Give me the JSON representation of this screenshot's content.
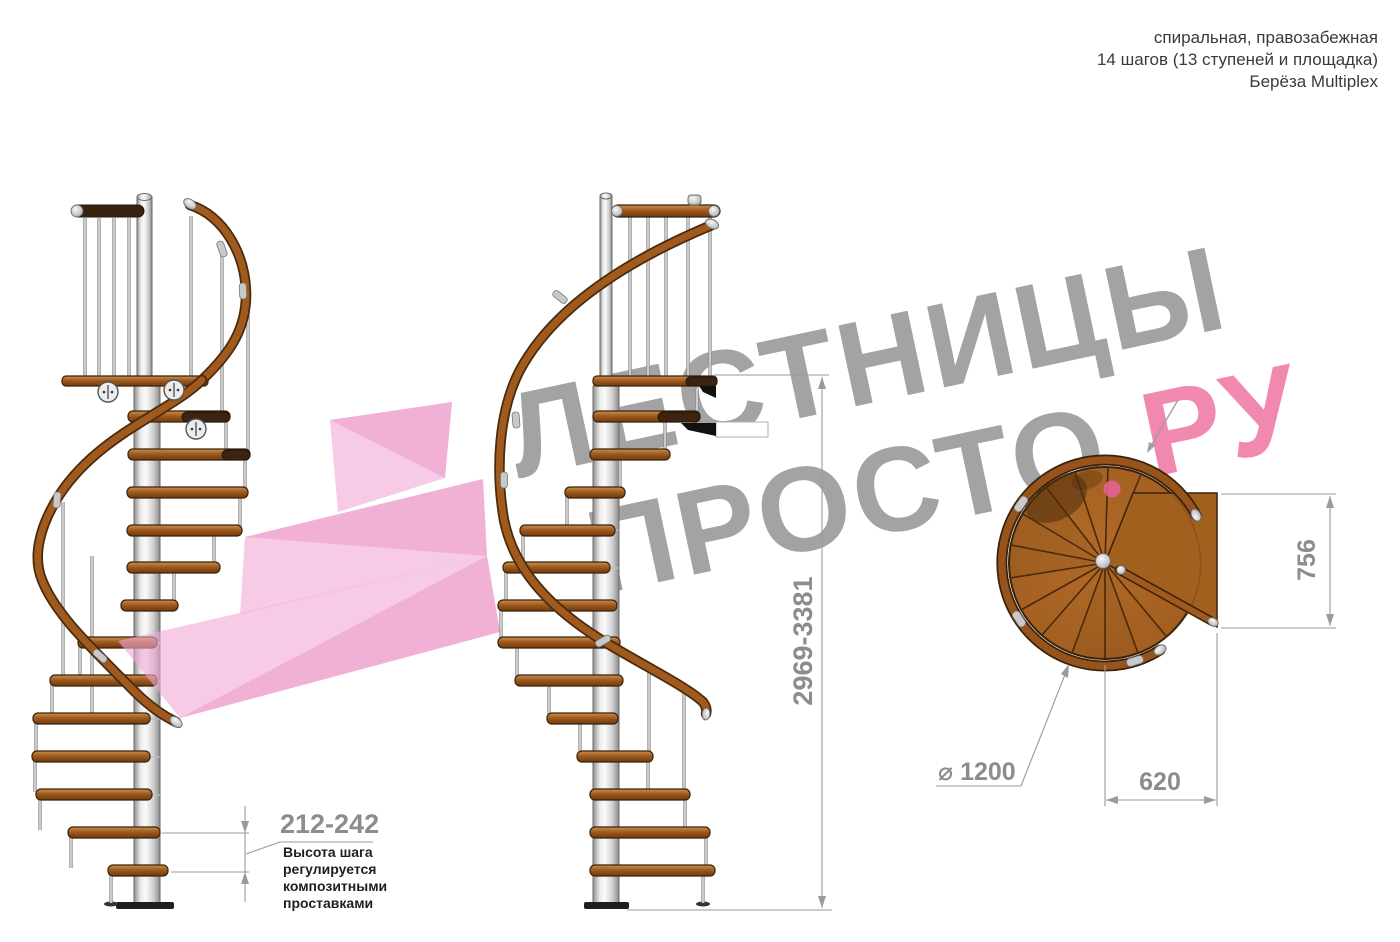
{
  "title": {
    "line1": "спиральная, правозабежная",
    "line2": "14 шагов (13 ступеней и площадка)",
    "line3": "Берёза Multiplex"
  },
  "watermark": {
    "line1": "ЛЕСТНИЦЫ",
    "line2_gray": "ПРОСТО",
    "line2_pink": ".РУ"
  },
  "dimensions": {
    "total_height": "2969-3381",
    "step_height": "212-242",
    "landing_depth": "756",
    "landing_width": "620",
    "diameter_symbol": "⌀",
    "diameter_value": "1200"
  },
  "note": {
    "line1": "Высота шага",
    "line2": "регулируется",
    "line3": "композитными",
    "line4": "проставками"
  },
  "colors": {
    "wood": "#a05a1e",
    "wood_dark": "#6f3a0f",
    "metal": "#d9d9d9",
    "watermark_gray": "#8f8f8f",
    "watermark_pink": "#ee6f9e",
    "arrow_pink": "#f2a8d4",
    "dimension_gray": "#8c8c8c",
    "background": "#ffffff"
  }
}
